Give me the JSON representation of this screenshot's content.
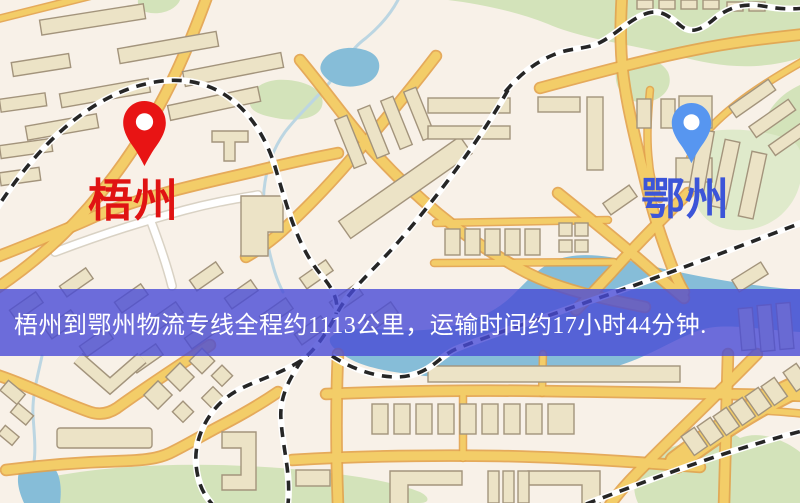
{
  "banner": {
    "text": "梧州到鄂州物流专线全程约1113公里，运输时间约17小时44分钟.",
    "background_color": "#4a4bd8",
    "text_color": "#ffffff"
  },
  "markers": {
    "origin": {
      "label": "梧州",
      "pin_color": "#e81414",
      "hole_color": "#ffffff",
      "label_color": "#e01313"
    },
    "destination": {
      "label": "鄂州",
      "pin_color": "#5796f0",
      "hole_color": "#ffffff",
      "label_color": "#3c55d8"
    }
  },
  "map_colors": {
    "background": "#f8f1e8",
    "road_fill": "#f3cd68",
    "road_casing": "#e2a24b",
    "railway": "#262626",
    "building_fill": "#ece3c6",
    "building_stroke": "#a3947c",
    "green_area": "#d3e3ba",
    "water": "#86bdd8"
  }
}
